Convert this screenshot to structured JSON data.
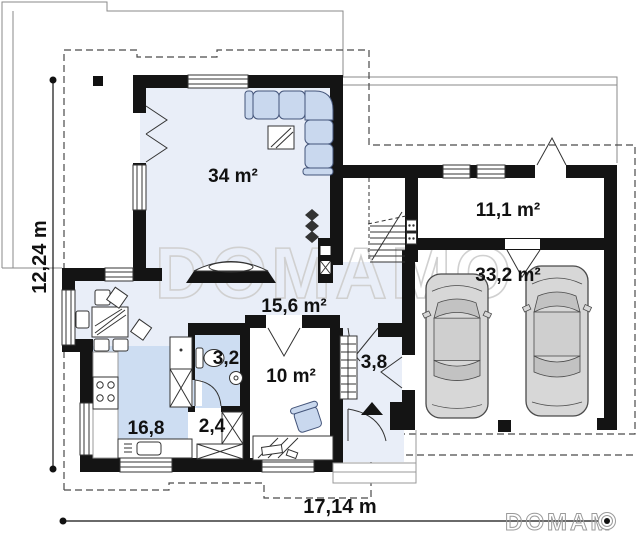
{
  "plan": {
    "rooms": {
      "living": {
        "label": "34 m²"
      },
      "hall": {
        "label": "15,6 m²"
      },
      "kitchen": {
        "label": "16,8"
      },
      "bathroom": {
        "label": "3,2"
      },
      "closet": {
        "label": "2,4"
      },
      "office": {
        "label": "10 m²"
      },
      "vestibule": {
        "label": "3,8"
      },
      "storage": {
        "label": "11,1 m²"
      },
      "garage": {
        "label": "33,2 m²"
      }
    },
    "dimensions": {
      "bottom_width": "17,14 m",
      "left_height": "12,24 m"
    },
    "branding": {
      "center_watermark": "DOMAMO",
      "corner_logo_text": "DOMAM"
    },
    "colors": {
      "wall": "#141414",
      "floor_light": "#e9eef8",
      "floor_medium": "#cdddf2",
      "furniture_blue": "#c9d8ee",
      "car_gray": "#d7d7d7",
      "watermark_gray": "#d0d0d0"
    }
  }
}
